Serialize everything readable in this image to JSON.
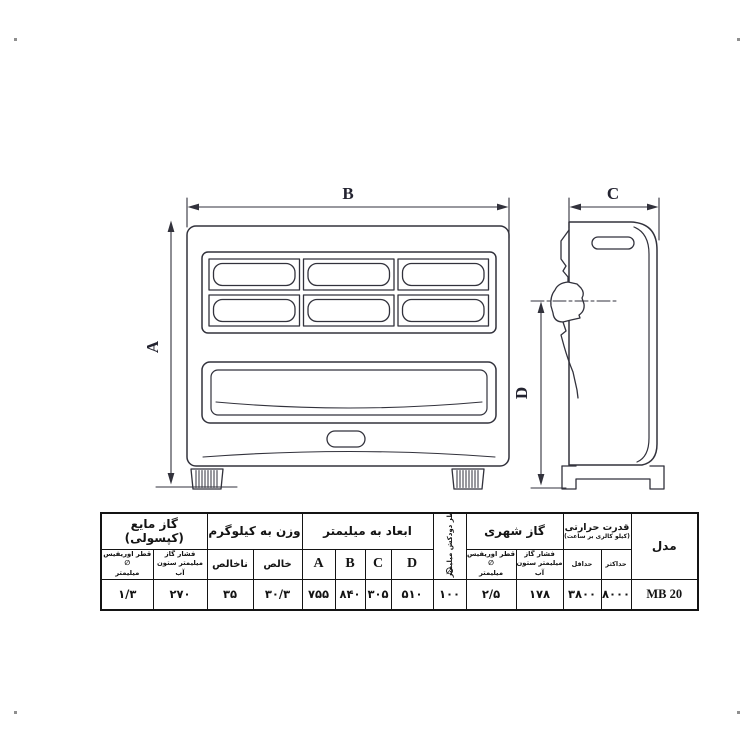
{
  "page": {
    "background": "#ffffff"
  },
  "drawing": {
    "line_color": "#32323c",
    "front_view": {
      "width_label": "B",
      "height_label": "A"
    },
    "side_view": {
      "depth_label": "C",
      "height_label": "D"
    }
  },
  "table": {
    "border_color": "#141414",
    "accent_color": "#e81a20",
    "model": {
      "header": "مدل",
      "value": "MB 20"
    },
    "thermal_power": {
      "header": "قدرت حرارتی",
      "subheader": "(کیلو کالری بر ساعت)",
      "min_label": "حداقل",
      "min_value": "۳۸۰۰",
      "max_label": "حداکثر",
      "max_value": "۸۰۰۰"
    },
    "city_gas": {
      "header": "گاز شهری",
      "pressure_label_line1": "فشار گاز",
      "pressure_label_line2": "میلیمتر ستون آب",
      "pressure_value": "۱۷۸",
      "orifice_label_line1": "قطر اوریفیس ∅",
      "orifice_label_line2": "میلیمتر",
      "orifice_value": "۲/۵"
    },
    "chimney": {
      "header": "قطر دودکش میلیمتر",
      "symbol": "∅",
      "value": "۱۰۰"
    },
    "dimensions": {
      "header": "ابعاد به میلیمتر",
      "a_label": "A",
      "b_label": "B",
      "c_label": "C",
      "d_label": "D",
      "a_value": "۷۵۵",
      "b_value": "۸۴۰",
      "c_value": "۳۰۵",
      "d_value": "۵۱۰"
    },
    "weight": {
      "header": "وزن به کیلوگرم",
      "gross_label": "ناخالص",
      "gross_value": "۳۵",
      "net_label": "خالص",
      "net_value": "۳۰/۳"
    },
    "liquid_gas": {
      "header": "گاز مایع (کپسولی)",
      "pressure_label_line1": "فشار گاز",
      "pressure_label_line2": "میلیمتر ستون آب",
      "pressure_value": "۲۷۰",
      "orifice_label_line1": "قطر اوریفیس ∅",
      "orifice_label_line2": "میلیمتر",
      "orifice_value": "۱/۳"
    }
  }
}
